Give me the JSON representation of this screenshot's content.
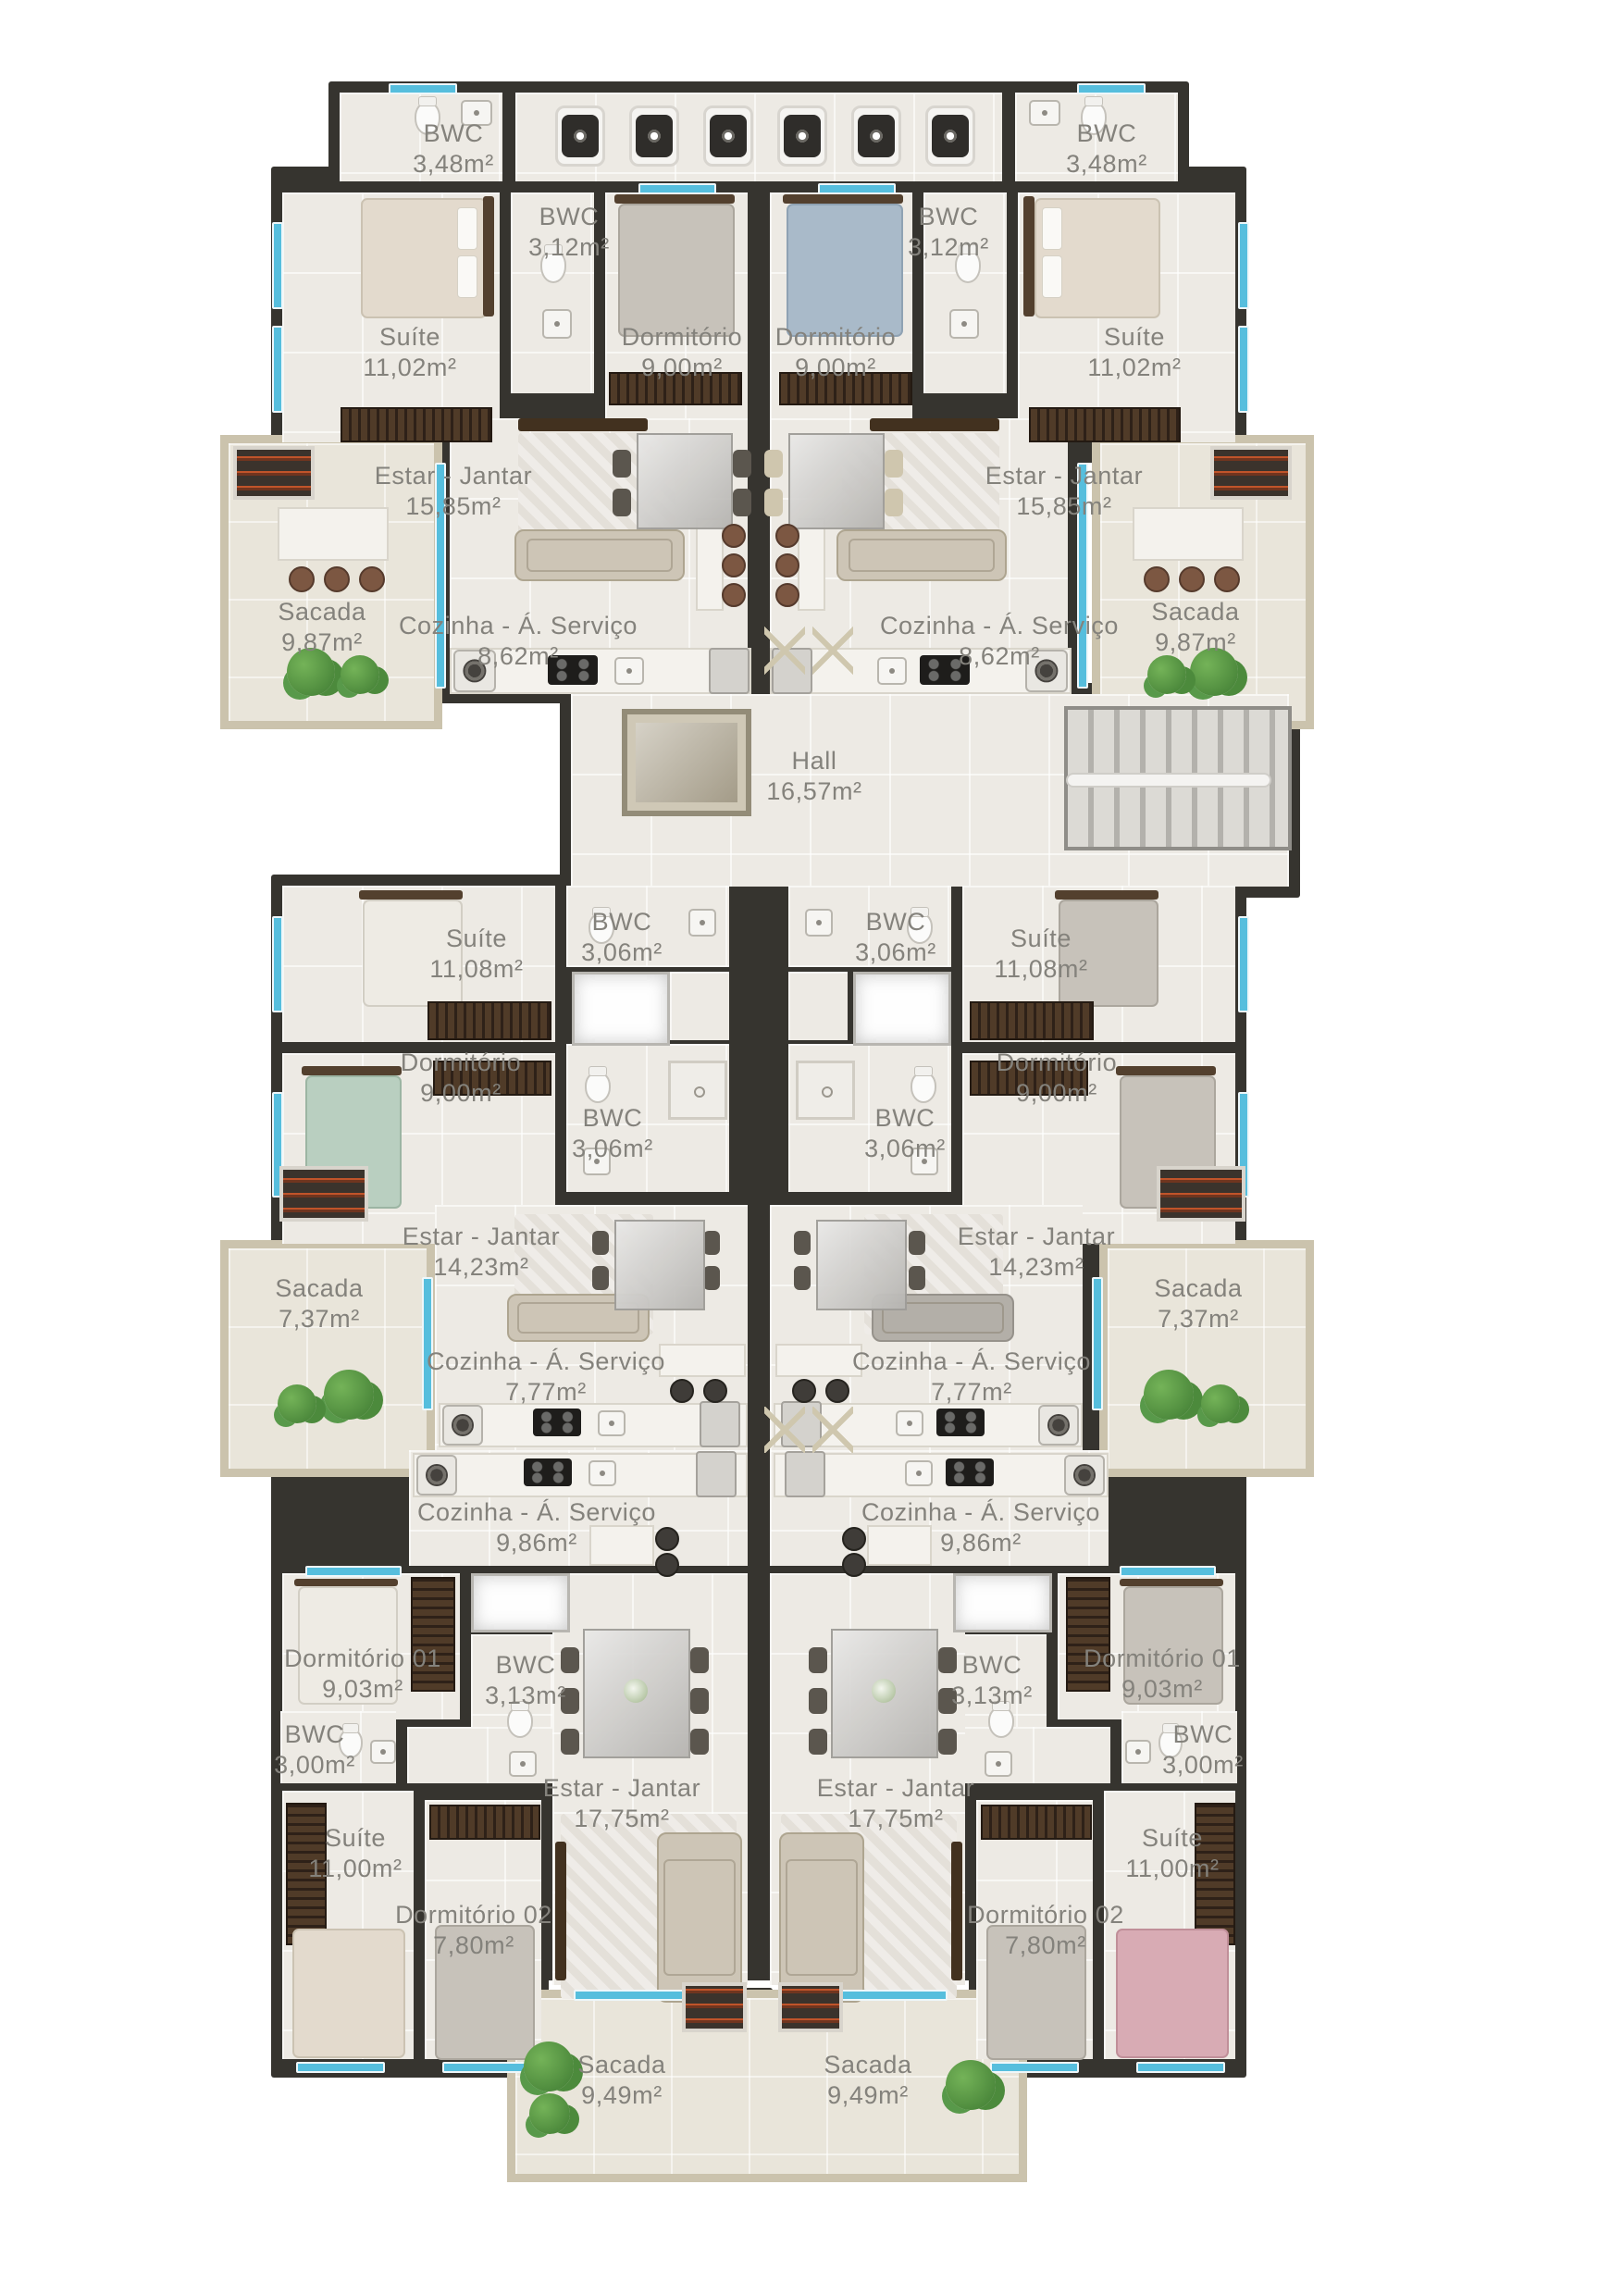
{
  "palette": {
    "wall": "#36342f",
    "floor": "#edeae4",
    "balcony_border": "#cbc3ad",
    "window": "#56bedd",
    "text": "#84827c",
    "plant": "#4f9c44"
  },
  "hall": {
    "name": "Hall",
    "area": "16,57m²"
  },
  "apartments": {
    "top_left": {
      "suite_bwc": {
        "name": "BWC",
        "area": "3,48m²"
      },
      "suite": {
        "name": "Suíte",
        "area": "11,02m²"
      },
      "bwc": {
        "name": "BWC",
        "area": "3,12m²"
      },
      "dormitorio": {
        "name": "Dormitório",
        "area": "9,00m²"
      },
      "estar_jantar": {
        "name": "Estar - Jantar",
        "area": "15,85m²"
      },
      "cozinha": {
        "name": "Cozinha - Á. Serviço",
        "area": "8,62m²"
      },
      "sacada": {
        "name": "Sacada",
        "area": "9,87m²"
      }
    },
    "top_right": {
      "suite_bwc": {
        "name": "BWC",
        "area": "3,48m²"
      },
      "suite": {
        "name": "Suíte",
        "area": "11,02m²"
      },
      "bwc": {
        "name": "BWC",
        "area": "3,12m²"
      },
      "dormitorio": {
        "name": "Dormitório",
        "area": "9,00m²"
      },
      "estar_jantar": {
        "name": "Estar - Jantar",
        "area": "15,85m²"
      },
      "cozinha": {
        "name": "Cozinha - Á. Serviço",
        "area": "8,62m²"
      },
      "sacada": {
        "name": "Sacada",
        "area": "9,87m²"
      }
    },
    "middle_left": {
      "suite": {
        "name": "Suíte",
        "area": "11,08m²"
      },
      "bwc_suite": {
        "name": "BWC",
        "area": "3,06m²"
      },
      "dormitorio": {
        "name": "Dormitório",
        "area": "9,00m²"
      },
      "bwc_social": {
        "name": "BWC",
        "area": "3,06m²"
      },
      "estar_jantar": {
        "name": "Estar - Jantar",
        "area": "14,23m²"
      },
      "cozinha": {
        "name": "Cozinha - Á. Serviço",
        "area": "7,77m²"
      },
      "sacada": {
        "name": "Sacada",
        "area": "7,37m²"
      }
    },
    "middle_right": {
      "suite": {
        "name": "Suíte",
        "area": "11,08m²"
      },
      "bwc_suite": {
        "name": "BWC",
        "area": "3,06m²"
      },
      "dormitorio": {
        "name": "Dormitório",
        "area": "9,00m²"
      },
      "bwc_social": {
        "name": "BWC",
        "area": "3,06m²"
      },
      "estar_jantar": {
        "name": "Estar - Jantar",
        "area": "14,23m²"
      },
      "cozinha": {
        "name": "Cozinha - Á. Serviço",
        "area": "7,77m²"
      },
      "sacada": {
        "name": "Sacada",
        "area": "7,37m²"
      }
    },
    "bottom_left": {
      "cozinha": {
        "name": "Cozinha - Á. Serviço",
        "area": "9,86m²"
      },
      "dormitorio_01": {
        "name": "Dormitório 01",
        "area": "9,03m²"
      },
      "bwc_social": {
        "name": "BWC",
        "area": "3,13m²"
      },
      "bwc_suite": {
        "name": "BWC",
        "area": "3,00m²"
      },
      "suite": {
        "name": "Suíte",
        "area": "11,00m²"
      },
      "dormitorio_02": {
        "name": "Dormitório 02",
        "area": "7,80m²"
      },
      "estar_jantar": {
        "name": "Estar - Jantar",
        "area": "17,75m²"
      },
      "sacada": {
        "name": "Sacada",
        "area": "9,49m²"
      }
    },
    "bottom_right": {
      "cozinha": {
        "name": "Cozinha - Á. Serviço",
        "area": "9,86m²"
      },
      "dormitorio_01": {
        "name": "Dormitório 01",
        "area": "9,03m²"
      },
      "bwc_social": {
        "name": "BWC",
        "area": "3,13m²"
      },
      "bwc_suite": {
        "name": "BWC",
        "area": "3,00m²"
      },
      "suite": {
        "name": "Suíte",
        "area": "11,00m²"
      },
      "dormitorio_02": {
        "name": "Dormitório 02",
        "area": "7,80m²"
      },
      "estar_jantar": {
        "name": "Estar - Jantar",
        "area": "17,75m²"
      },
      "sacada": {
        "name": "Sacada",
        "area": "9,49m²"
      }
    }
  }
}
